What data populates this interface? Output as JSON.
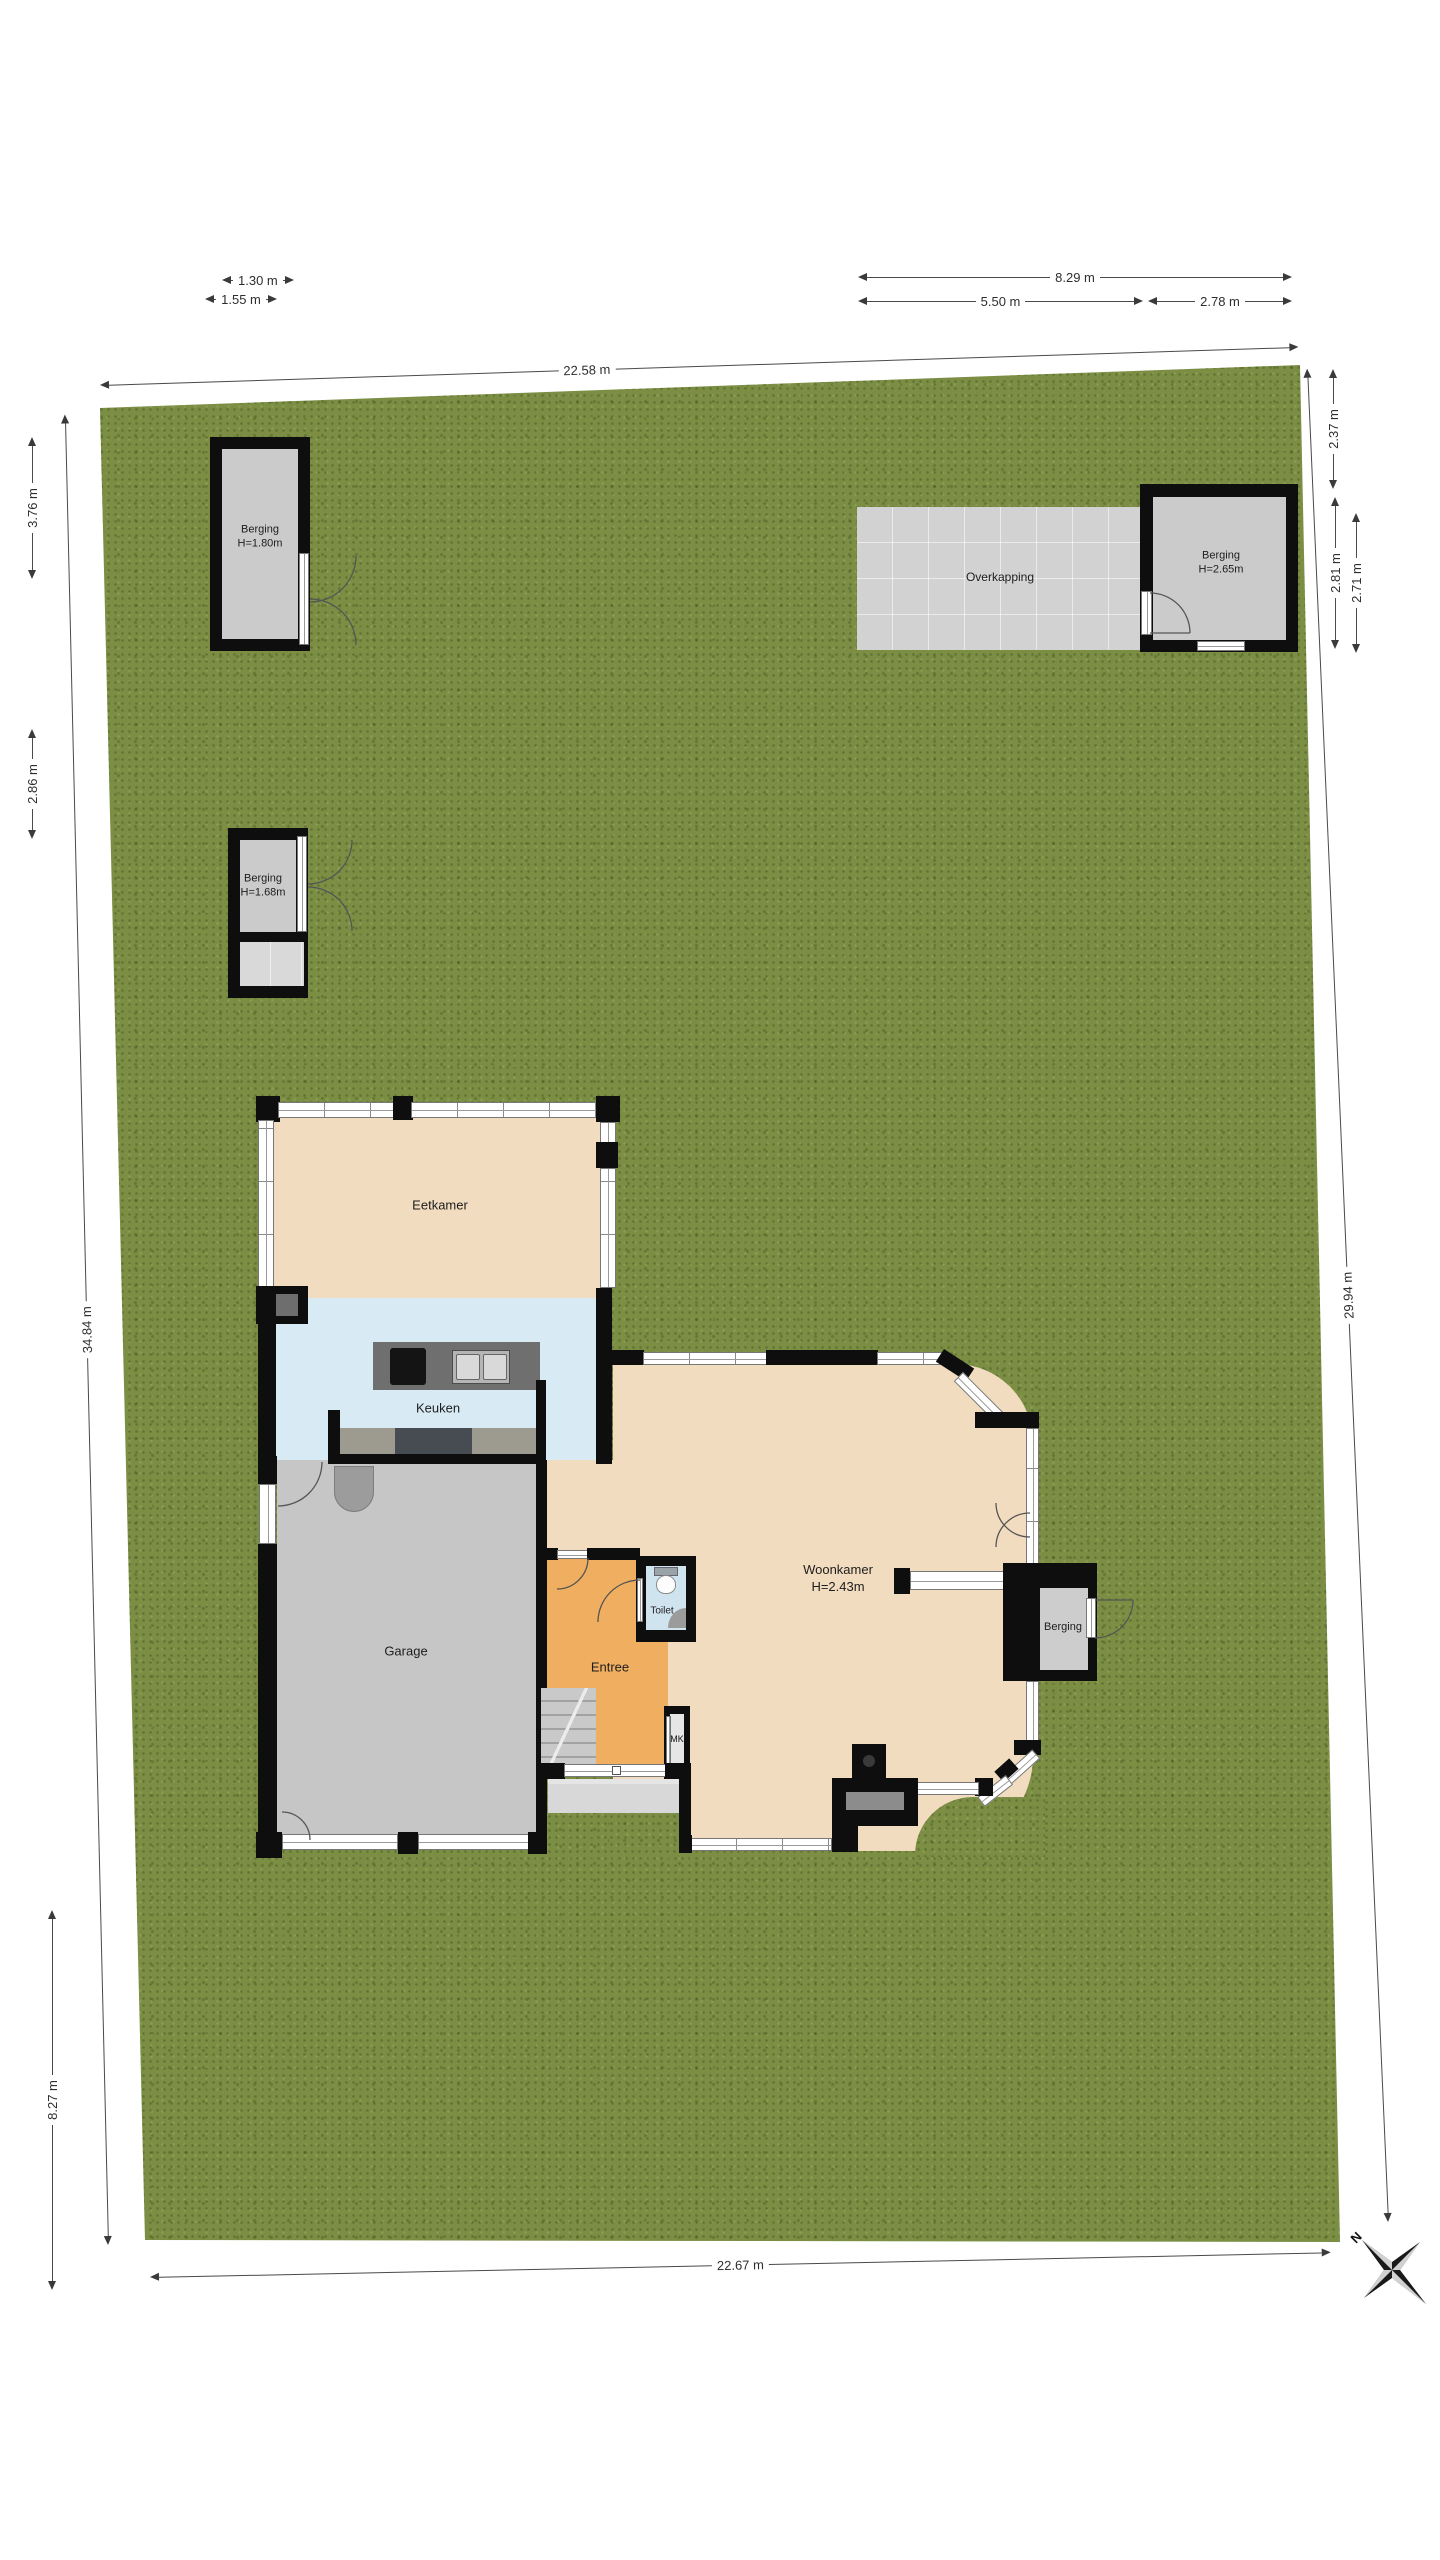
{
  "plan": {
    "type": "residential floor plan with garden lot",
    "language": "Dutch"
  },
  "outbuildings": {
    "top_left": {
      "name": "Berging",
      "height": "H=1.80m"
    },
    "canopy": {
      "name": "Overkapping"
    },
    "top_right": {
      "name": "Berging",
      "height": "H=2.65m"
    },
    "mid_left": {
      "name": "Berging",
      "height": "H=1.68m"
    },
    "attached": {
      "name": "Berging"
    }
  },
  "rooms": {
    "eetkamer": {
      "name": "Eetkamer"
    },
    "keuken": {
      "name": "Keuken"
    },
    "garage": {
      "name": "Garage"
    },
    "entree": {
      "name": "Entree"
    },
    "toilet": {
      "name": "Toilet"
    },
    "meterkast": {
      "name": "MK"
    },
    "woonkamer": {
      "name": "Woonkamer",
      "height": "H=2.43m"
    }
  },
  "dimensions": {
    "d_1_30": "1.30 m",
    "d_1_55": "1.55 m",
    "d_22_58": "22.58 m",
    "d_8_29": "8.29 m",
    "d_5_50": "5.50 m",
    "d_2_78": "2.78 m",
    "d_2_37": "2.37 m",
    "d_2_81": "2.81 m",
    "d_2_71": "2.71 m",
    "d_3_76": "3.76 m",
    "d_2_86": "2.86 m",
    "d_34_84": "34.84 m",
    "d_29_94": "29.94 m",
    "d_8_27": "8.27 m",
    "d_22_67": "22.67 m"
  },
  "compass": {
    "north_label": "N"
  },
  "colors": {
    "grass": "#7b8e44",
    "wall": "#0e0e0e",
    "dining_floor": "#f2dcc0",
    "kitchen_floor": "#d8eaf4",
    "living_floor": "#f2dcc0",
    "garage_floor": "#c6c6c6",
    "entree_floor": "#f0af60",
    "toilet_floor": "#cfe4ef",
    "storage_floor": "#cbcbcb",
    "canopy_floor": "#d2d2d2",
    "window": "#ffffff"
  }
}
